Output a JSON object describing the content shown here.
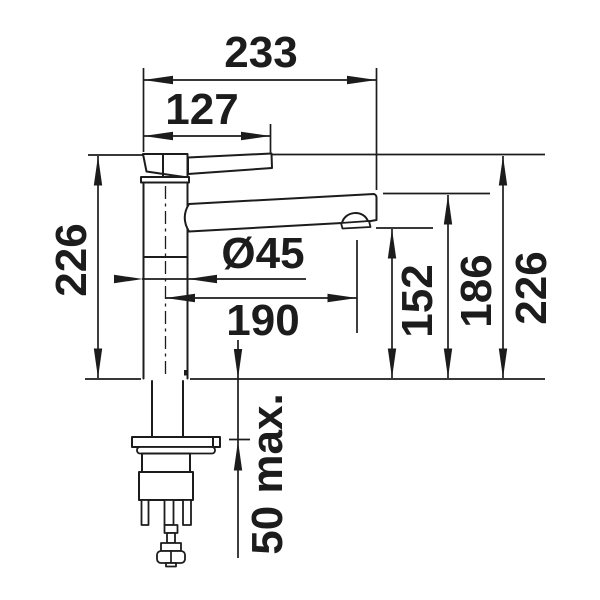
{
  "drawing": {
    "title": "kitchen faucet dimensional drawing, side view",
    "background_color": "#ffffff",
    "line_color": "#1c1c1c",
    "scale": "1 px = 1 mm",
    "labels": {
      "overall_projection": "233",
      "lever_length": "127",
      "body_diameter": "Ø45",
      "spout_reach": "190",
      "outlet_height": "152",
      "spout_tip_height": "186",
      "total_height_left": "226",
      "total_height_right": "226",
      "max_mounting_thickness": "50 max."
    }
  }
}
